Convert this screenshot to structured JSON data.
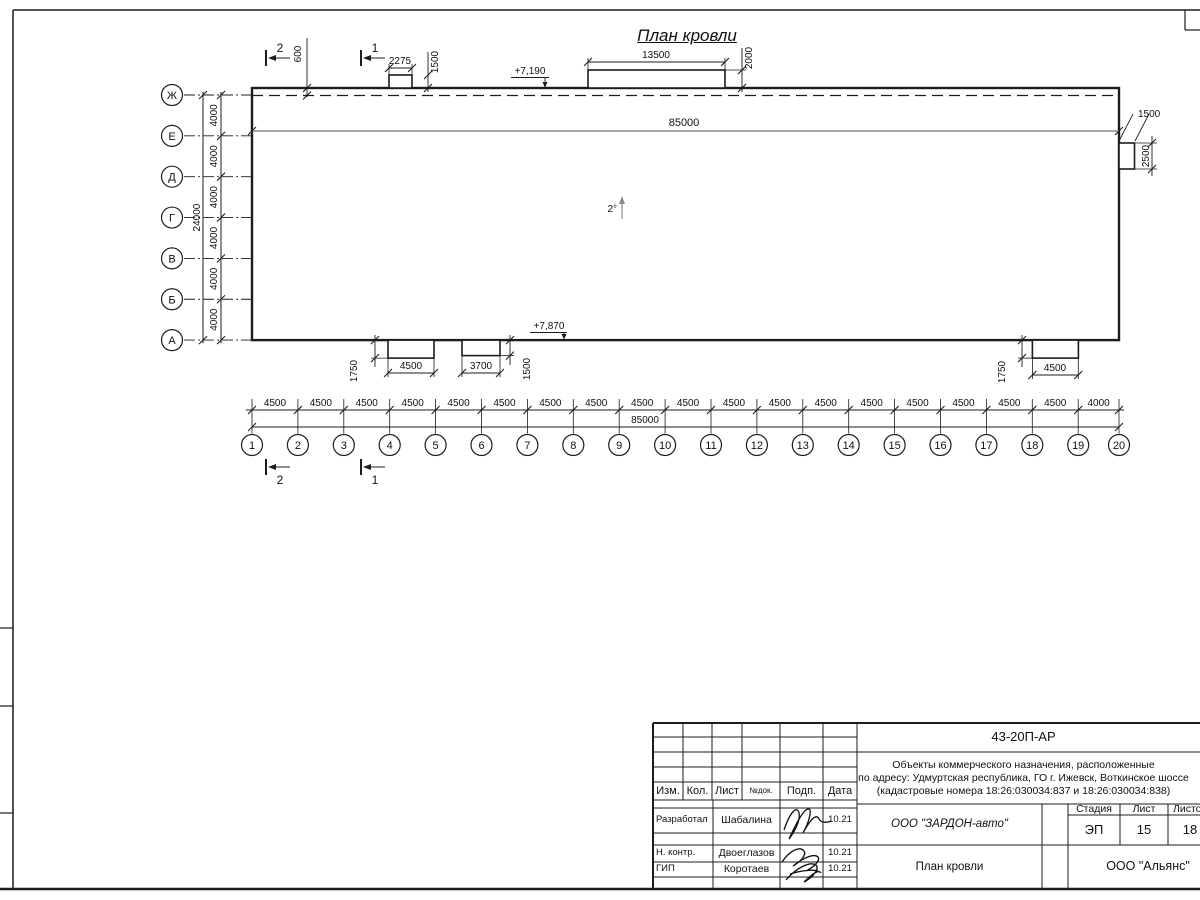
{
  "sheet_title": "План кровли",
  "plan": {
    "axes_vertical": {
      "labels": [
        "Ж",
        "Е",
        "Д",
        "Г",
        "В",
        "Б",
        "А"
      ],
      "spacing_labels": [
        "4000",
        "4000",
        "4000",
        "4000",
        "4000",
        "4000"
      ],
      "total_label": "24000"
    },
    "axes_horizontal": {
      "labels": [
        "1",
        "2",
        "3",
        "4",
        "5",
        "6",
        "7",
        "8",
        "9",
        "10",
        "11",
        "12",
        "13",
        "14",
        "15",
        "16",
        "17",
        "18",
        "19",
        "20"
      ],
      "spacing_labels": [
        "4500",
        "4500",
        "4500",
        "4500",
        "4500",
        "4500",
        "4500",
        "4500",
        "4500",
        "4500",
        "4500",
        "4500",
        "4500",
        "4500",
        "4500",
        "4500",
        "4500",
        "4500",
        "4000"
      ],
      "total_label": "85000"
    },
    "ridge_length_label": "85000",
    "slope_label": "2°",
    "elevation_top": "+7,190",
    "elevation_bottom": "+7,870",
    "parapet_offset_label": "600",
    "section_marks": {
      "left": "2",
      "right": "1"
    },
    "dims": {
      "canopy_top_small_width": "2275",
      "canopy_top_small_depth": "1500",
      "canopy_top_large_width": "13500",
      "canopy_top_large_depth": "2000",
      "canopy_bottom1_width": "4500",
      "canopy_bottom1_depth": "1750",
      "canopy_bottom2_width": "3700",
      "canopy_bottom2_depth": "1500",
      "canopy_bottom3_width": "4500",
      "canopy_bottom3_depth": "1750",
      "right_box_width": "1500",
      "right_box_height": "2500"
    }
  },
  "title_block": {
    "code": "43-20П-АР",
    "project_lines": [
      "Объекты коммерческого назначения, расположенные",
      "по адресу: Удмуртская республика, ГО г. Ижевск, Воткинское шоссе",
      "(кадастровые номера 18:26:030034:837 и 18:26:030034:838)"
    ],
    "header_cols": [
      "Изм.",
      "Кол.",
      "Лист",
      "№док.",
      "Подп.",
      "Дата"
    ],
    "sig_rows": [
      {
        "role": "Разработал",
        "name": "Шабалина",
        "date": "10.21"
      },
      {
        "role": "Н. контр.",
        "name": "Двоеглазов",
        "date": "10.21"
      },
      {
        "role": "ГИП",
        "name": "Коротаев",
        "date": "10.21"
      }
    ],
    "org": "ООО \"ЗАРДОН-авто\"",
    "stage_cols": [
      "Стадия",
      "Лист",
      "Листов"
    ],
    "stage_values": [
      "ЭП",
      "15",
      "18"
    ],
    "drawing_name": "План кровли",
    "company": "ООО \"Альянс\""
  },
  "colors": {
    "line": "#1c1c1c",
    "gray": "#8a8a8a",
    "bg": "#ffffff"
  }
}
